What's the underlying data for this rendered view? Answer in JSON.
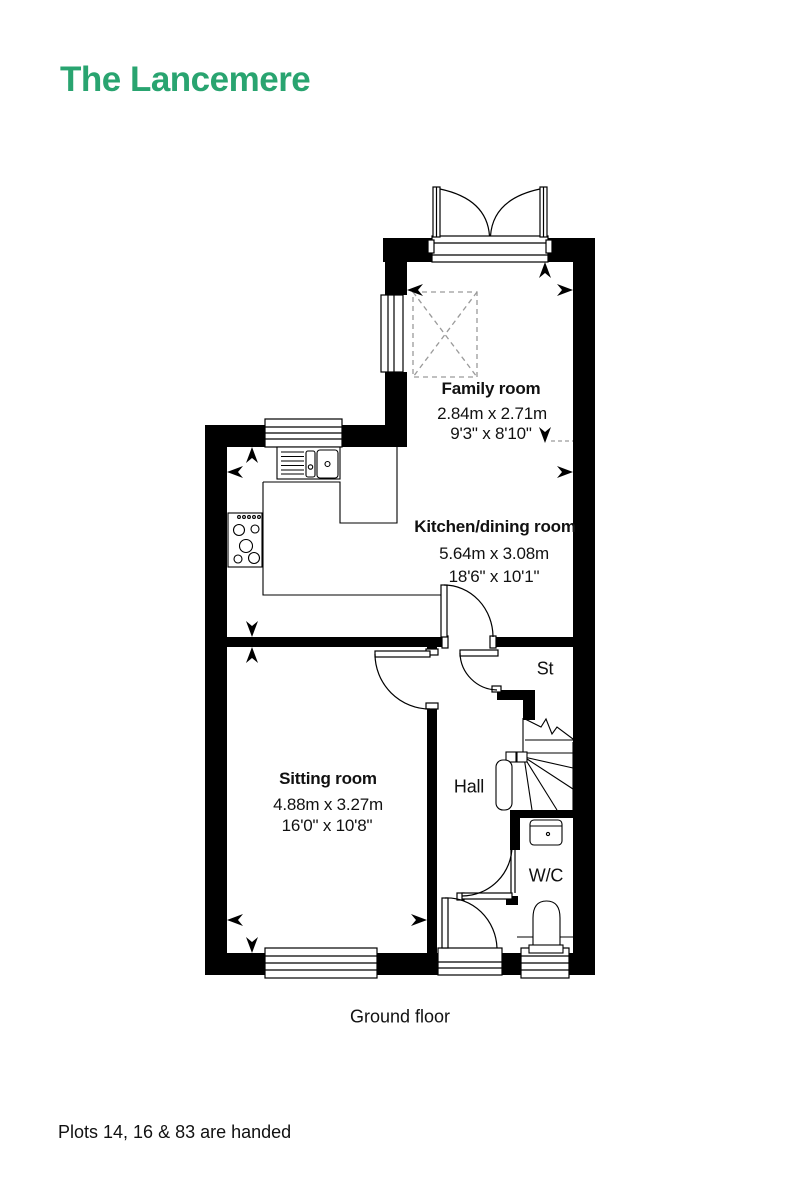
{
  "header": {
    "title": "The Lancemere",
    "accent_color": "#29a470"
  },
  "plan": {
    "floor_label": "Ground floor",
    "rooms": {
      "family_room": {
        "name": "Family room",
        "metric": "2.84m x 2.71m",
        "imperial": "9'3\" x 8'10\""
      },
      "kitchen_dining": {
        "name": "Kitchen/dining room",
        "metric": "5.64m x 3.08m",
        "imperial": "18'6\" x 10'1\""
      },
      "sitting_room": {
        "name": "Sitting room",
        "metric": "4.88m x 3.27m",
        "imperial": "16'0\" x 10'8\""
      },
      "storage": {
        "name": "St"
      },
      "hall": {
        "name": "Hall"
      },
      "wc": {
        "name": "W/C"
      }
    }
  },
  "footer": {
    "note": "Plots 14, 16 & 83 are handed"
  }
}
